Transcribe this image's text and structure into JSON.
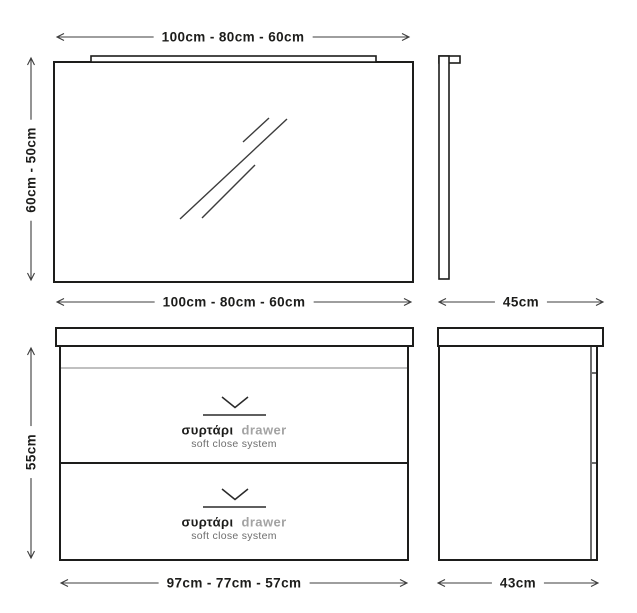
{
  "colors": {
    "ink": "#1d1d1b",
    "dim": "#3d3d3d",
    "rail": "#9a9a9a",
    "muted": "#a3a3a3",
    "sub": "#6e6e6e",
    "bg": "#ffffff",
    "drawerline": "#6e6e6e"
  },
  "icons": {
    "drawer_open": "chevron-down"
  },
  "mirror": {
    "front": {
      "width_label": "100cm - 80cm - 60cm",
      "height_label": "60cm - 50cm"
    },
    "side": {
      "depth_label": "45cm"
    }
  },
  "cabinet": {
    "front": {
      "width_label": "100cm - 80cm - 60cm",
      "height_label": "55cm",
      "bottom_width_label": "97cm - 77cm - 57cm",
      "drawers": [
        {
          "label_gr": "συρτάρι",
          "label_en": "drawer",
          "subtitle": "soft close system"
        },
        {
          "label_gr": "συρτάρι",
          "label_en": "drawer",
          "subtitle": "soft close system"
        }
      ]
    },
    "side": {
      "depth_label": "43cm"
    }
  }
}
